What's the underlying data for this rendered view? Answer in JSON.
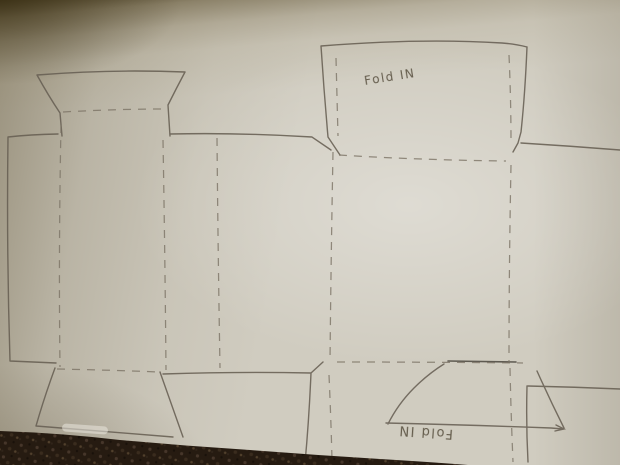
{
  "drawing": {
    "top_flap_label": "Fold IN",
    "bottom_flap_label": "Fold IN",
    "line_color": "#675f53",
    "dash_color": "#7c7466",
    "dark_line_color": "#4a453d",
    "carpet_color": "#261b11",
    "carpet_fleck_color": "#46362a",
    "paper_color": "#d0ccc0"
  }
}
